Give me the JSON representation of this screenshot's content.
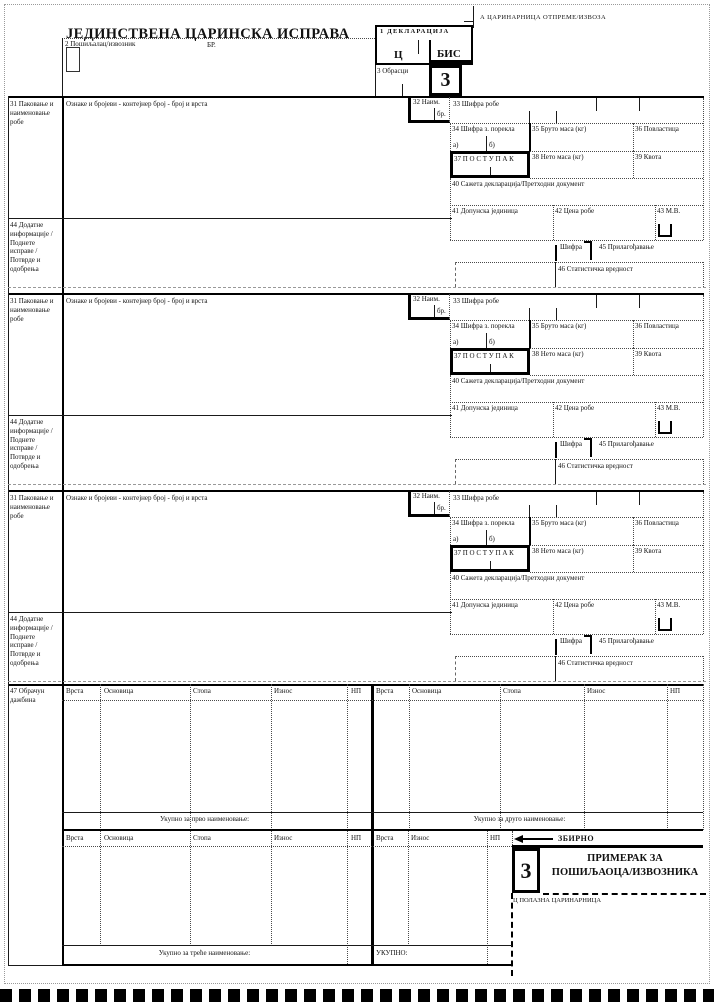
{
  "header": {
    "title": "ЈЕДИНСТВЕНА ЦАРИНСКА ИСПРАВА",
    "box_a": "А ЦАРИНАРНИЦА ОТПРЕМЕ/ИЗВОЗА",
    "box_2_label": "2 Пошиљалац/извозник",
    "box_2_no": "БР.",
    "box_1_label": "1 ДЕКЛАРАЦИЈА",
    "box_1_c": "Ц",
    "box_1_bis": "БИС",
    "box_3_label": "3 Обрасци",
    "box_3_value": "3"
  },
  "block": {
    "f31": "31 Паковање и\nнаименовање\nробе",
    "marks": "Ознаке и бројеви - контејнер број - број и врста",
    "f32": "32 Наим.",
    "f32_br": "бр.",
    "f33": "33 Шифра робе",
    "f34": "34 Шифра з. порекла",
    "f34_a": "а)",
    "f34_b": "б)",
    "f35": "35 Бруто маса  (кг)",
    "f36": "36 Повластица",
    "f37": "37 П О С Т У П А К",
    "f38": "38 Нето маса  (кг)",
    "f39": "39 Квота",
    "f40": "40 Сажета декларација/Претходни документ",
    "f41": "41 Допунска јединица",
    "f42": "42 Цена робе",
    "f43": "43 М.В.",
    "f43_code": "Шифра",
    "f45": "45 Прилагођавање",
    "f46": "46 Статистичка вредност",
    "f44": "44 Додатне\nинформације /\nПоднете\nисправе /\nПотврде и\nодобрења"
  },
  "charges": {
    "f47": "47 Обрачун\nдажбина",
    "col_vrsta": "Врста",
    "col_osnovica": "Основица",
    "col_stopa": "Стопа",
    "col_iznos": "Износ",
    "col_np": "НП",
    "total_first": "Укупно за прво наименовање:",
    "total_second": "Укупно за друго наименовање:",
    "total_third": "Укупно за треће наименовање:",
    "total_all": "УКУПНО:",
    "summary": "ЗБИРНО"
  },
  "footer": {
    "copy_number": "3",
    "copy_for_1": "ПРИМЕРАК ЗА",
    "copy_for_2": "ПОШИЉАОЦА/ИЗВОЗНИКА",
    "box_c": "Ц ПОЛАЗНА ЦАРИНАРНИЦА"
  }
}
